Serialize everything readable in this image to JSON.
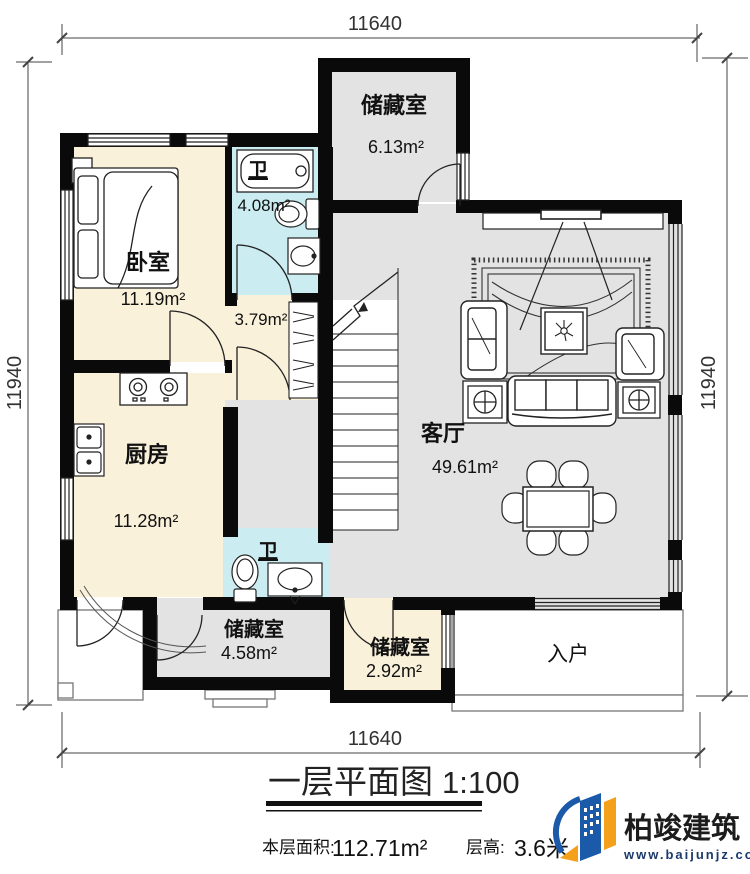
{
  "dims": {
    "top": "11640",
    "bottom": "11640",
    "left": "11940",
    "right": "11940"
  },
  "rooms": {
    "storage_top": {
      "name": "储藏室",
      "area": "6.13m²"
    },
    "bedroom": {
      "name": "卧室",
      "area": "11.19m²"
    },
    "bath_top": {
      "name": "卫",
      "area": "4.08m²"
    },
    "hall": {
      "area": "3.79m²"
    },
    "kitchen": {
      "name": "厨房",
      "area": "11.28m²"
    },
    "bath_bottom": {
      "name": "卫"
    },
    "living": {
      "name": "客厅",
      "area": "49.61m²"
    },
    "storage_left": {
      "name": "储藏室",
      "area": "4.58m²"
    },
    "storage_right": {
      "name": "储藏室",
      "area": "2.92m²"
    },
    "entrance": {
      "name": "入户"
    }
  },
  "title": {
    "name": "一层平面图",
    "scale": "1:100"
  },
  "stats": {
    "area_label": "本层面积:",
    "area_value": "112.71m²",
    "height_label": "层高:",
    "height_value": "3.6米"
  },
  "brand": {
    "name": "柏竣建筑",
    "url": "www.baijunjz.com"
  },
  "watermark": {
    "name": "柏竣建筑",
    "url": "www.baijunjz.com"
  },
  "colors": {
    "wall": "#0a0a0a",
    "floor_warm": "#faf1da",
    "floor_bath": "#cbedf2",
    "floor_gray": "#e3e3e3",
    "brand_blue": "#1a5aa8",
    "brand_orange": "#f5a01a",
    "brand_navy": "#1a3a6b"
  }
}
